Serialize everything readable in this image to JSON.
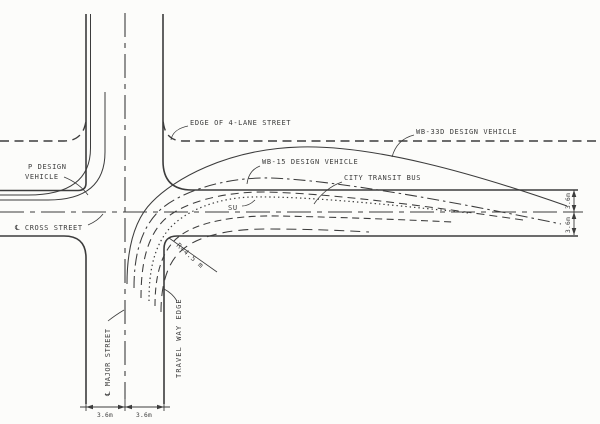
{
  "figure": {
    "type": "intersection-turning-path-diagram",
    "labels": {
      "edge_of_4_lane_street": "EDGE OF 4-LANE STREET",
      "wb_33d_design_vehicle": "WB-33D DESIGN VEHICLE",
      "wb_15_design_vehicle": "WB-15 DESIGN VEHICLE",
      "city_transit_bus": "CITY TRANSIT BUS",
      "su": "SU",
      "p_design_vehicle_line1": "P DESIGN",
      "p_design_vehicle_line2": "VEHICLE",
      "cross_street": "℄ CROSS STREET",
      "major_street": "℄ MAJOR STREET",
      "travel_way_edge": "TRAVEL WAY EDGE",
      "corner_radius": "R=4.5 m"
    },
    "dimensions": {
      "major_street_left_lane": "3.6m",
      "major_street_right_lane": "3.6m",
      "cross_street_upper_lane": "3.6m",
      "cross_street_lower_lane": "3.6m"
    },
    "colors": {
      "ink": "#3c3c3c",
      "paper": "#fcfcfa"
    }
  }
}
